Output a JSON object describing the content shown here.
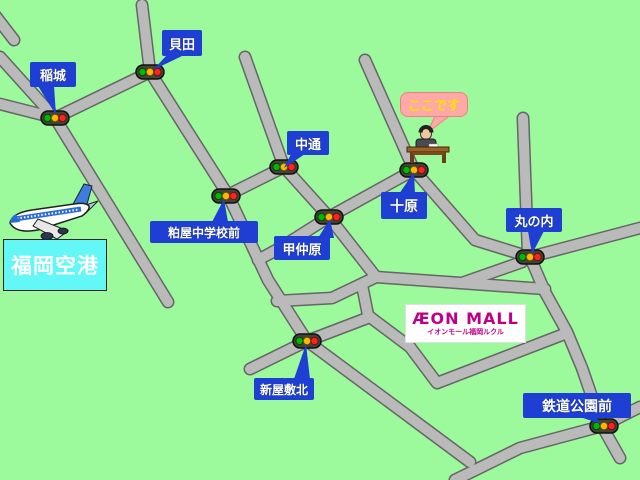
{
  "map": {
    "background_color": "#9cfa9c",
    "road_fill_color": "#bababa",
    "road_border_color": "#666666",
    "label_box_color": "#1f3fd4",
    "label_text_color": "#ffffff",
    "labels": {
      "inagi": "稲城",
      "kaida": "貝田",
      "nakadori": "中通",
      "kasuya_chugakko_mae": "粕屋中学校前",
      "konakabaru": "甲仲原",
      "tohara": "十原",
      "marunouchi": "丸の内",
      "shin_yashiki_kita": "新屋敷北",
      "tetsudo_koen_mae": "鉄道公園前"
    },
    "here_balloon": {
      "text": "ここです",
      "bg_color": "#ffa8a8",
      "text_color": "#ffe400"
    },
    "airport": {
      "label": "福岡空港",
      "bg_color": "#63f7f7",
      "text_color": "#ffffff"
    },
    "mall": {
      "name": "ÆON MALL",
      "subtitle": "イオンモール福岡ルクル",
      "brand_color": "#bf0087",
      "bg_color": "#ffffff"
    },
    "traffic_light_colors": {
      "body": "#3f4434",
      "green": "#00b800",
      "yellow": "#ffb800",
      "red": "#ff2222"
    },
    "icons": [
      "traffic-light-icon",
      "airplane-icon",
      "reception-desk-icon"
    ]
  }
}
